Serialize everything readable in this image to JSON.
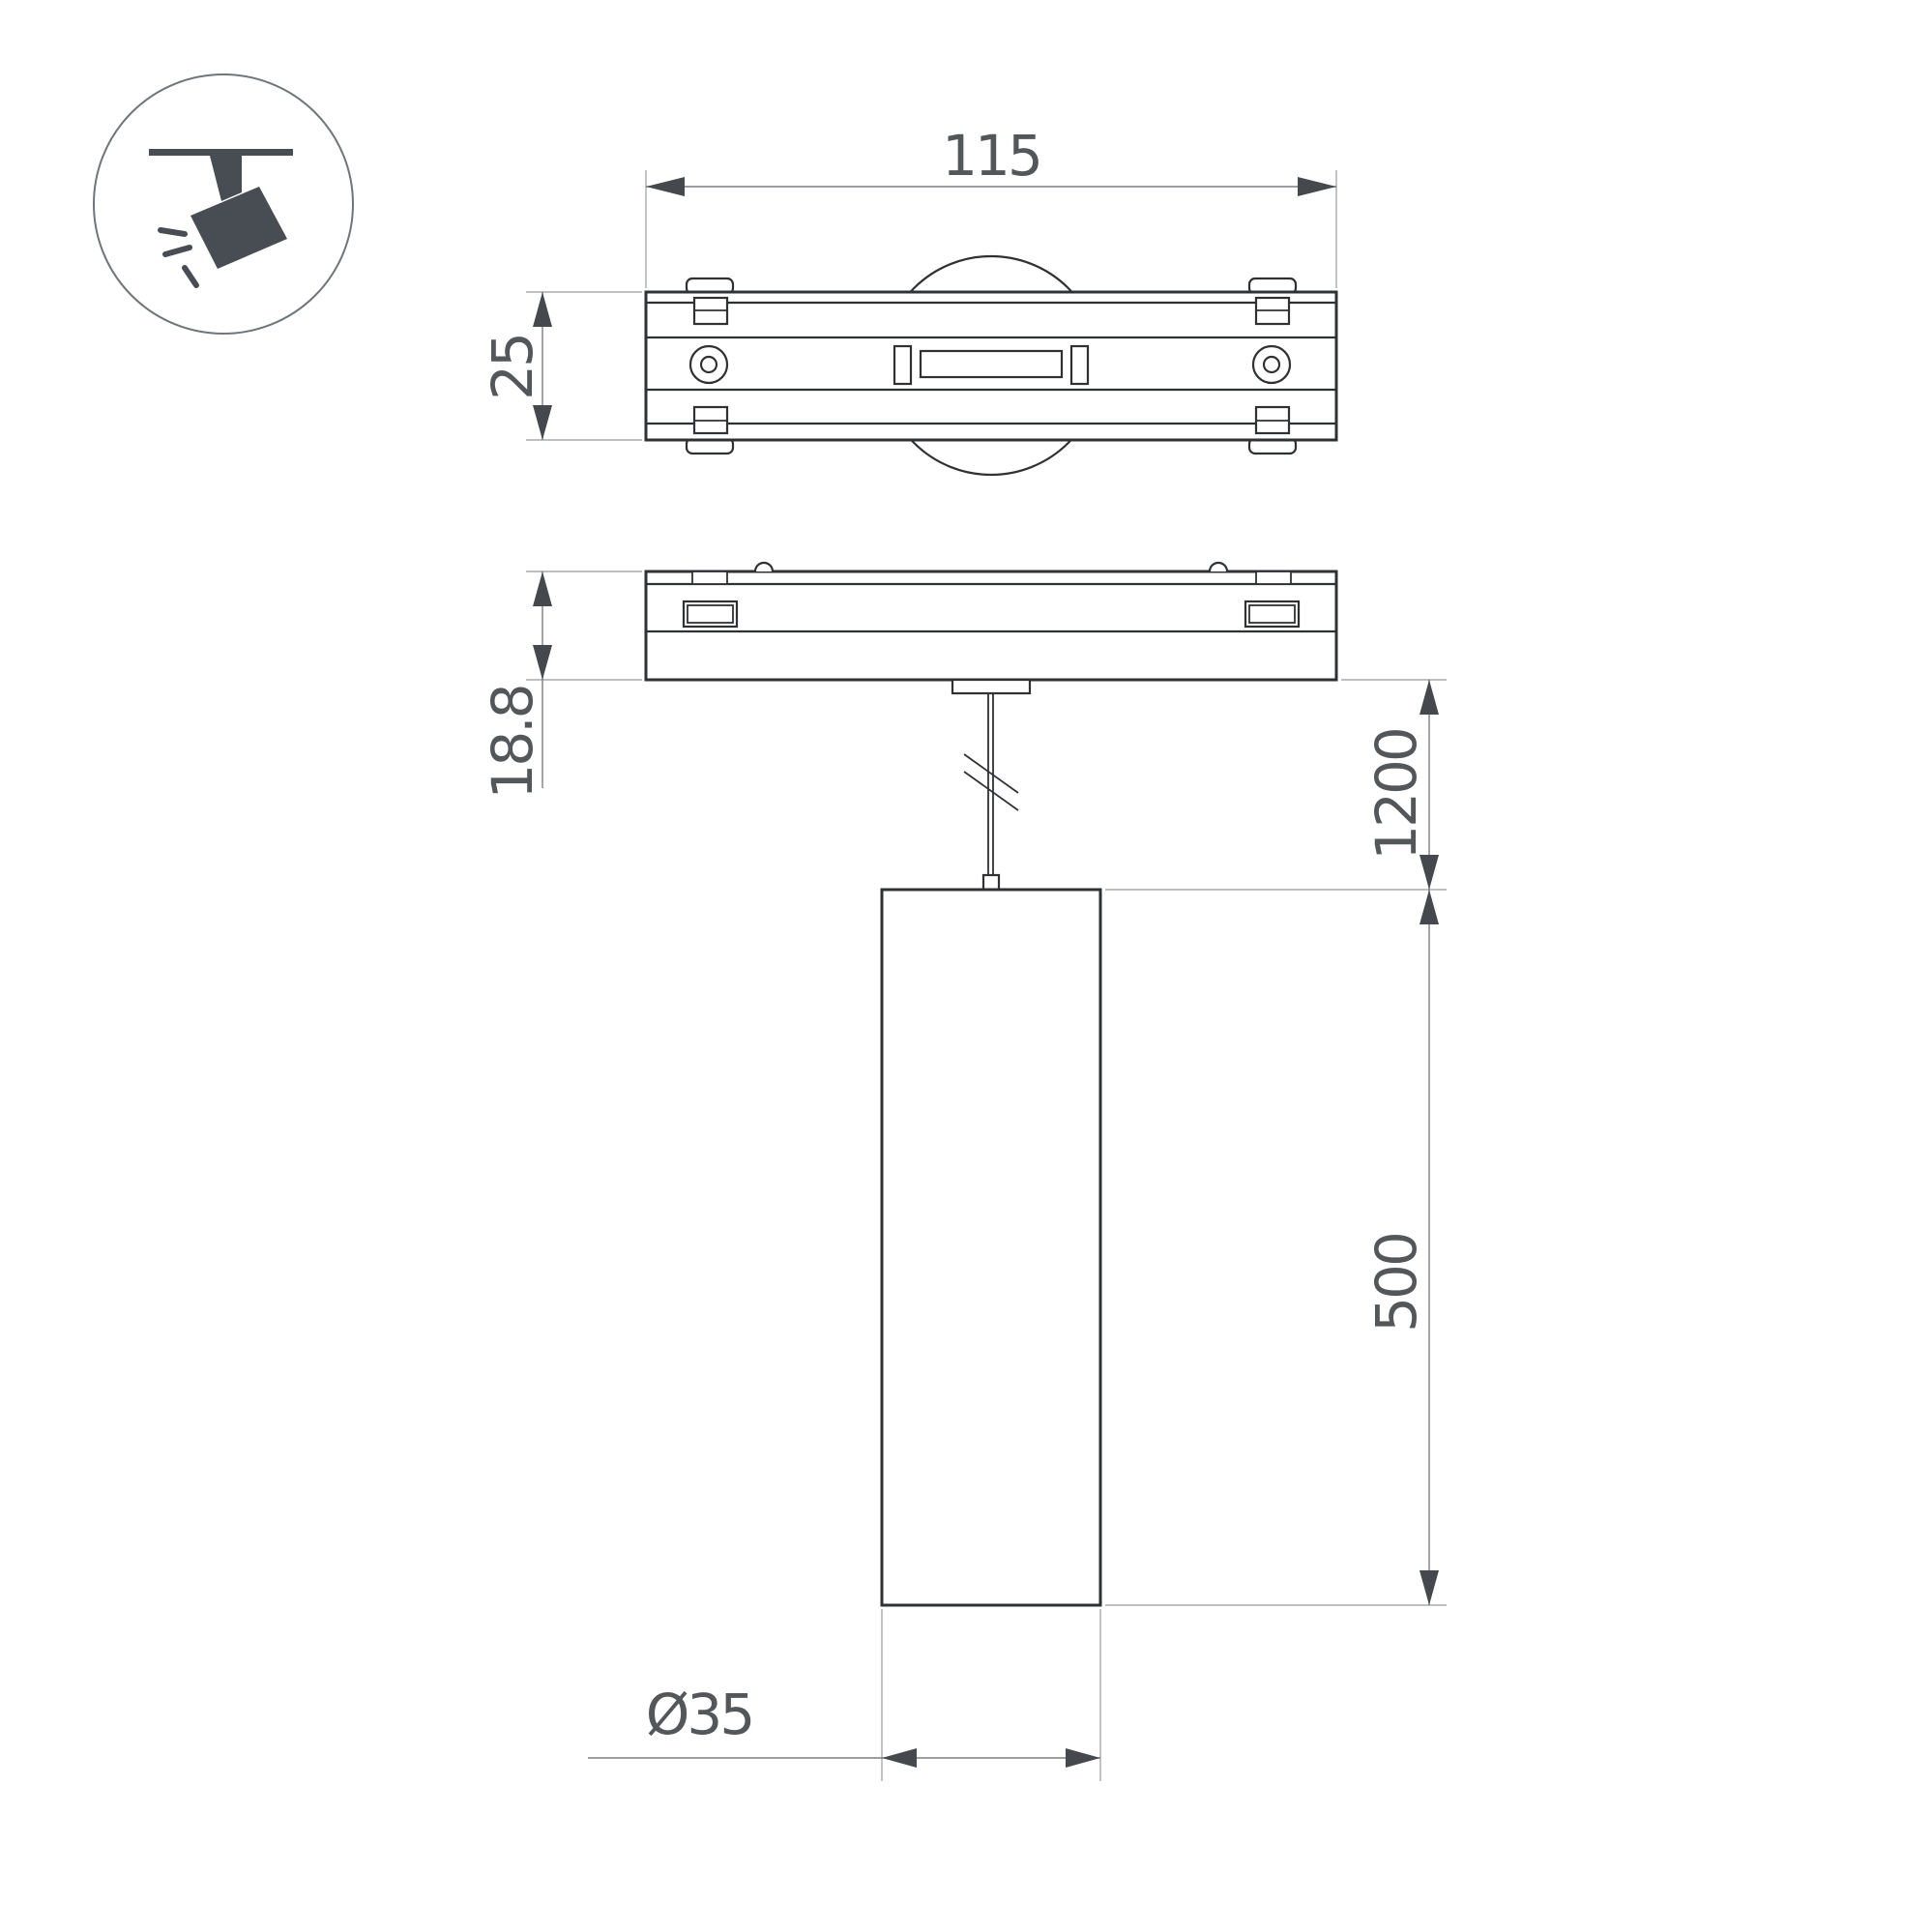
{
  "colors": {
    "line": "#2f3133",
    "dim": "#7c7f82",
    "ext": "#a8aaac",
    "arrow": "#45494d",
    "text": "#54575a",
    "icon": "#474d53",
    "iconring": "#70757a"
  },
  "dimensions": {
    "track_width": "115",
    "track_depth": "25",
    "adapter_height": "18.8",
    "suspension_length": "1200",
    "lamp_height": "500",
    "lamp_diameter": "Ø35"
  },
  "icons": {
    "track_spotlight": "track-spotlight-icon"
  }
}
